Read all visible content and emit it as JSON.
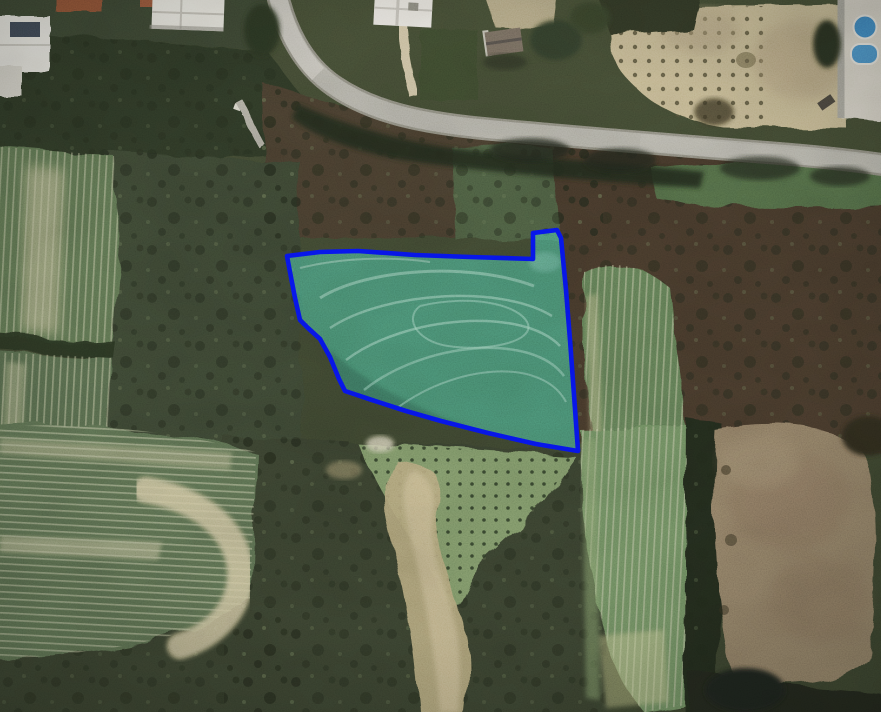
{
  "map": {
    "view": "satellite",
    "image_width": 881,
    "image_height": 712,
    "parcel": {
      "name": "highlighted-land-parcel",
      "stroke_color": "#0715f2",
      "stroke_width": 4.6,
      "fill_color": "#52d2b2",
      "fill_opacity": 0.5,
      "points": [
        [
          287,
          256
        ],
        [
          320,
          252
        ],
        [
          358,
          251
        ],
        [
          415,
          255
        ],
        [
          470,
          257
        ],
        [
          533,
          259
        ],
        [
          533,
          233
        ],
        [
          557,
          230
        ],
        [
          561,
          238
        ],
        [
          566,
          290
        ],
        [
          570,
          340
        ],
        [
          574,
          395
        ],
        [
          578,
          451
        ],
        [
          536,
          444
        ],
        [
          488,
          433
        ],
        [
          441,
          421
        ],
        [
          406,
          411
        ],
        [
          372,
          400
        ],
        [
          345,
          391
        ],
        [
          339,
          379
        ],
        [
          330,
          357
        ],
        [
          320,
          339
        ],
        [
          308,
          328
        ],
        [
          300,
          320
        ],
        [
          295,
          298
        ],
        [
          290,
          272
        ]
      ],
      "points_str": "287,256 320,252 358,251 415,255 470,257 533,259 533,233 557,230 561,238 566,290 570,340 574,395 578,451 536,444 488,433 441,421 406,411 372,400 345,391 339,379 330,357 320,339 308,328 300,320 295,298 290,272"
    },
    "features": [
      {
        "name": "paved-road",
        "color": "#b2b0a6"
      },
      {
        "name": "tan-orchard-field",
        "color": "#c8ba92"
      },
      {
        "name": "swimming-pools",
        "color": "#3f86c4"
      },
      {
        "name": "white-rooftops",
        "color": "#e9e6df"
      },
      {
        "name": "green-crop-fields",
        "color": "#5c7150"
      },
      {
        "name": "plowed-brown-field",
        "color": "#8d7b63"
      },
      {
        "name": "olive-grove",
        "color": "#7c9466"
      },
      {
        "name": "dry-wash",
        "color": "#b5a67c"
      },
      {
        "name": "dense-scrub",
        "color": "#3a4430"
      }
    ],
    "palette": {
      "background": "#3d452f"
    }
  }
}
